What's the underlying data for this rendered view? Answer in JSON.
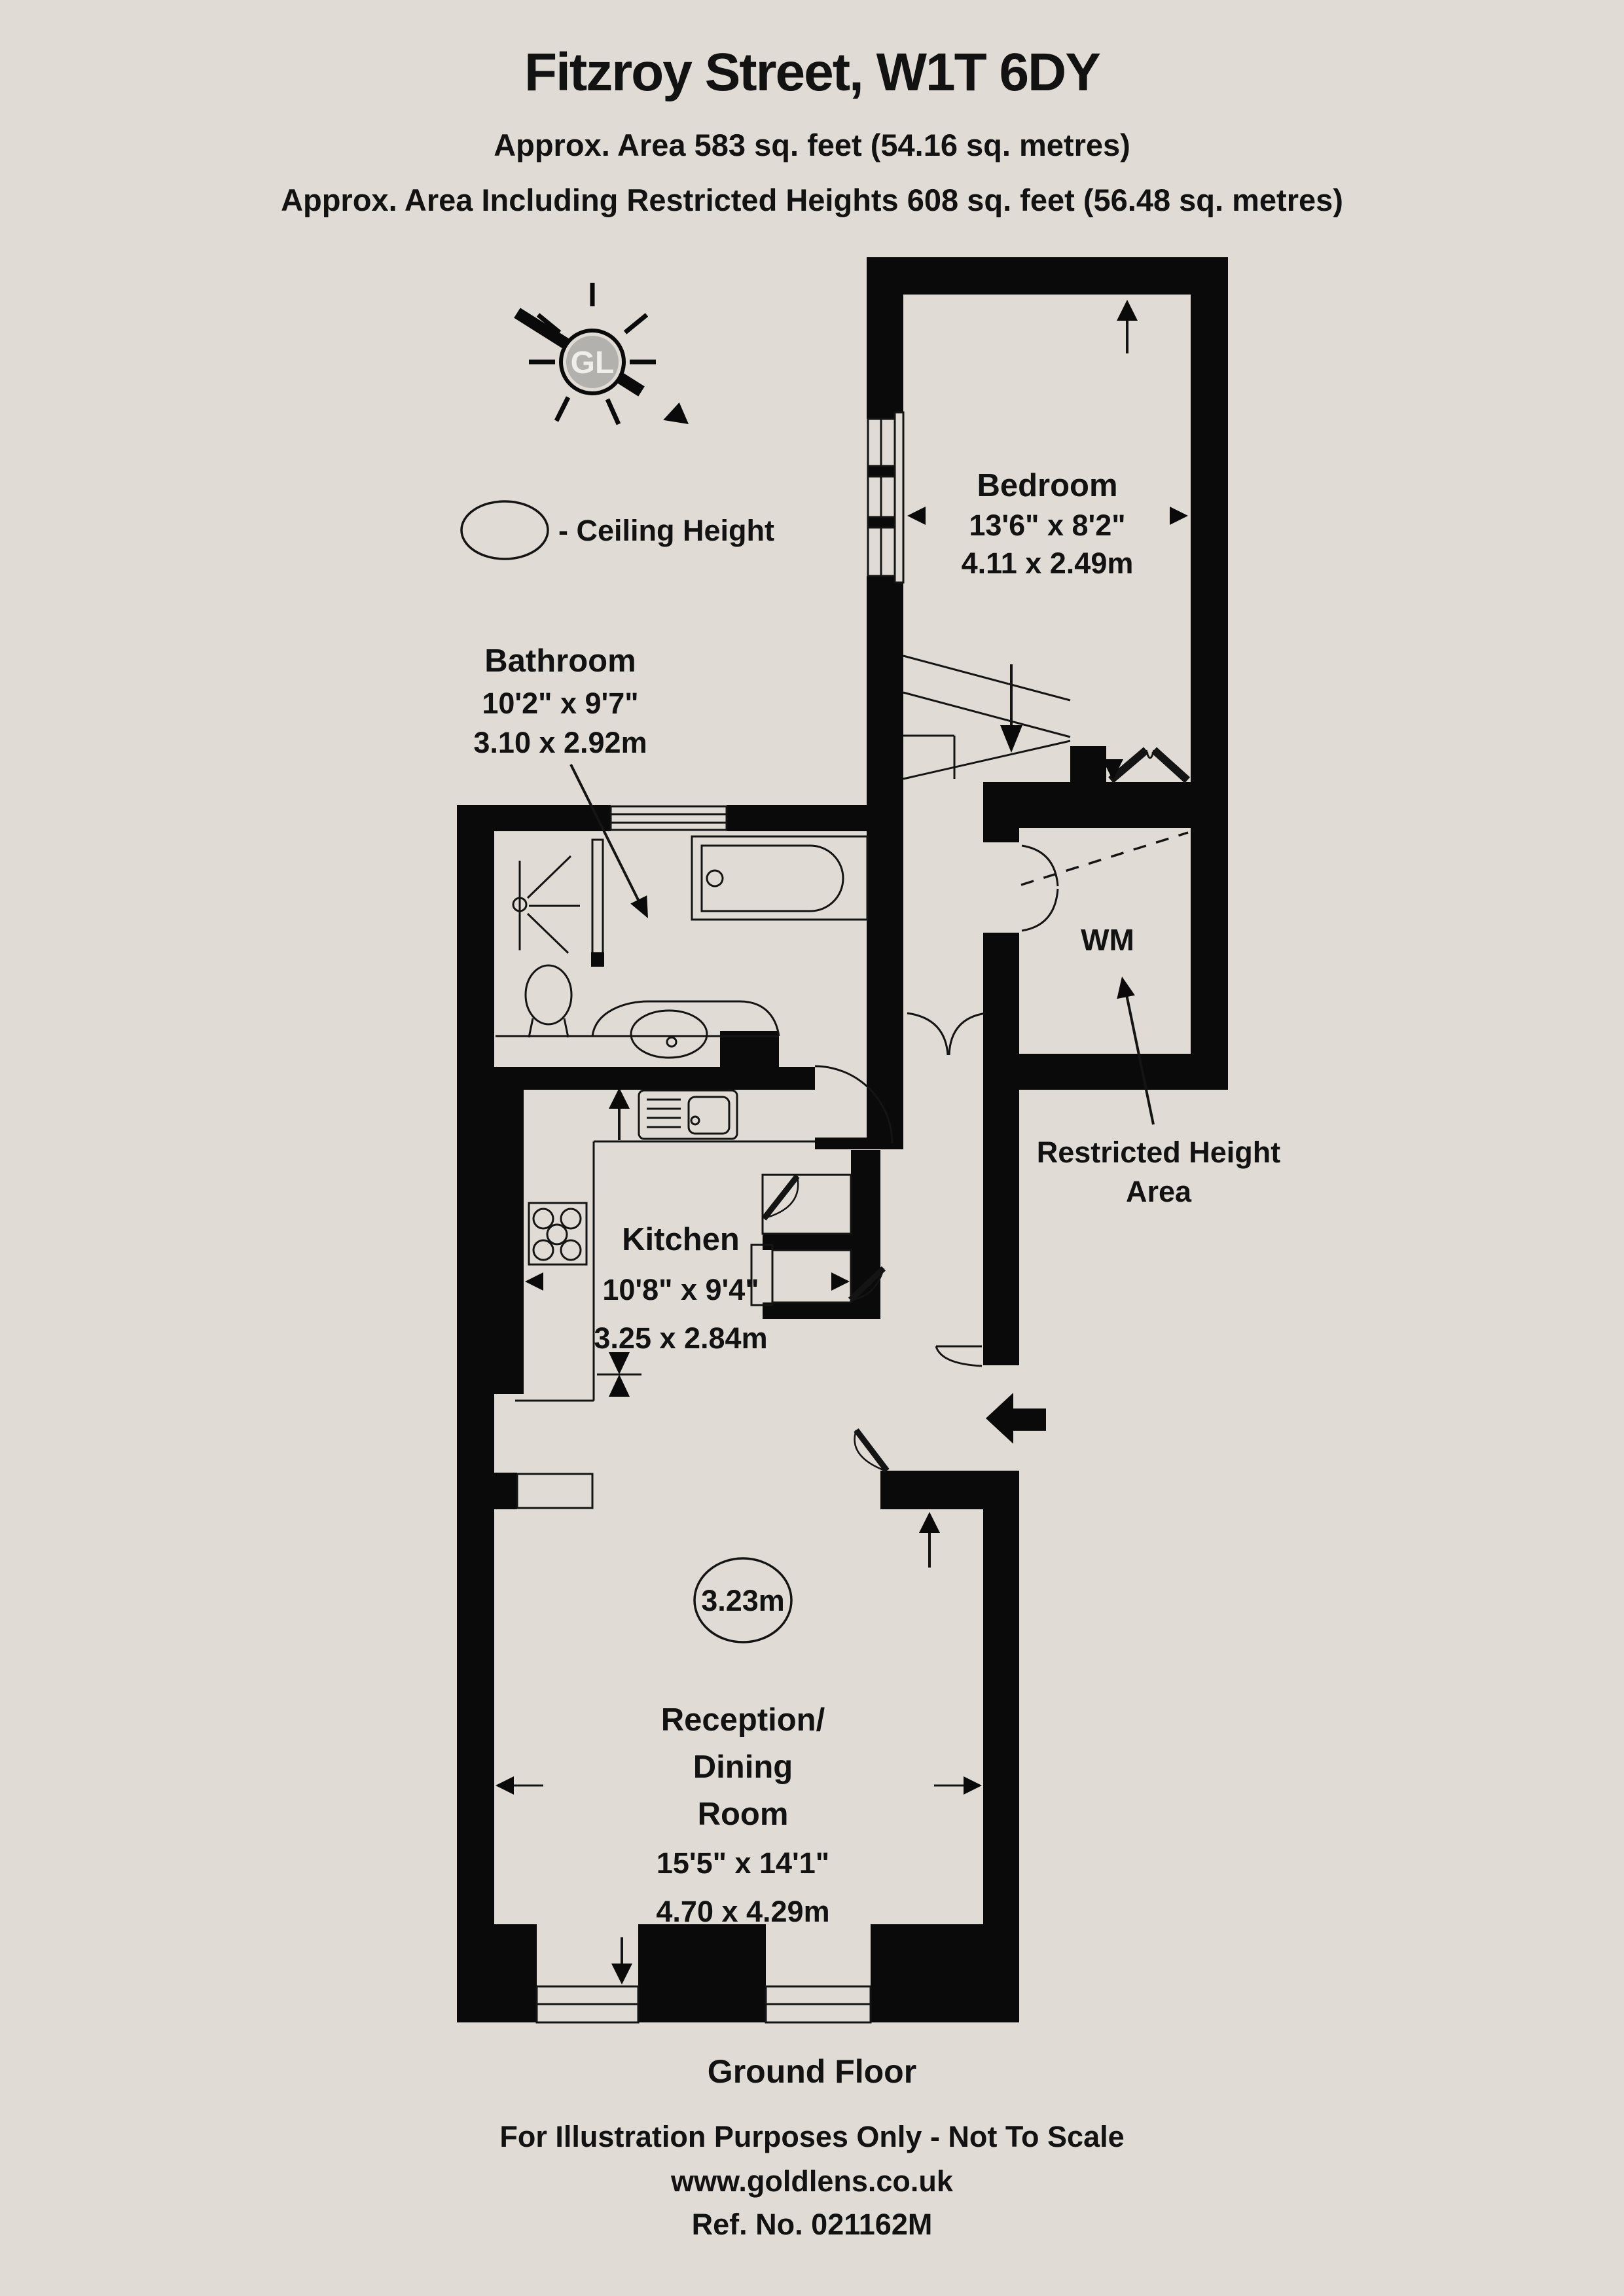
{
  "header": {
    "title": "Fitzroy Street, W1T 6DY",
    "area_line1": "Approx. Area 583 sq. feet (54.16 sq. metres)",
    "area_line2": "Approx. Area Including Restricted Heights 608 sq. feet (56.48 sq. metres)"
  },
  "logo": {
    "initials": "GL"
  },
  "legend": {
    "ceiling_height_label": "- Ceiling Height"
  },
  "rooms": {
    "bedroom": {
      "name": "Bedroom",
      "imperial": "13'6\" x 8'2\"",
      "metric": "4.11 x 2.49m"
    },
    "bathroom": {
      "name": "Bathroom",
      "imperial": "10'2\" x 9'7\"",
      "metric": "3.10 x 2.92m"
    },
    "kitchen": {
      "name": "Kitchen",
      "imperial": "10'8\" x 9'4\"",
      "metric": "3.25 x 2.84m"
    },
    "reception": {
      "name_line1": "Reception/",
      "name_line2": "Dining",
      "name_line3": "Room",
      "imperial": "15'5\" x 14'1\"",
      "metric": "4.70 x 4.29m",
      "ceiling_height": "3.23m"
    },
    "wm": {
      "name": "WM"
    },
    "restricted": {
      "line1": "Restricted Height",
      "line2": "Area"
    }
  },
  "footer": {
    "floor_label": "Ground Floor",
    "disclaimer": "For Illustration Purposes Only - Not To Scale",
    "website": "www.goldlens.co.uk",
    "reference": "Ref. No. 021162M"
  },
  "colors": {
    "background": "#e0dcd5",
    "wall": "#0a0a0a",
    "logo_disc": "#b3b1ae"
  }
}
